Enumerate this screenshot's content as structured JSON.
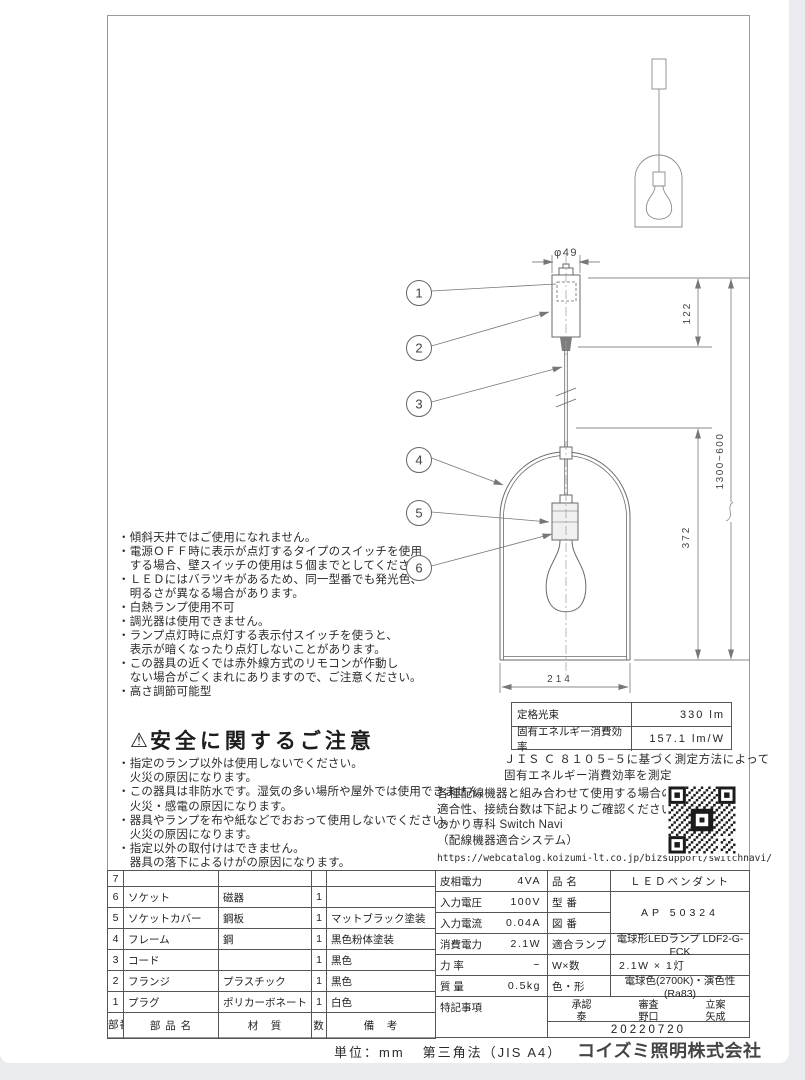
{
  "frame": {
    "unit_label": "単位：mm",
    "projection": "第三角法（JIS A4）",
    "company": "コイズミ照明株式会社"
  },
  "usage_notes": {
    "lines": [
      "・傾斜天井ではご使用になれません。",
      "・電源ＯＦＦ時に表示が点灯するタイプのスイッチを使用",
      "　する場合、壁スイッチの使用は５個までとしてください。",
      "・ＬＥＤにはバラツキがあるため、同一型番でも発光色、",
      "　明るさが異なる場合があります。",
      "・白熱ランプ使用不可",
      "・調光器は使用できません。",
      "・ランプ点灯時に点灯する表示付スイッチを使うと、",
      "　表示が暗くなったり点灯しないことがあります。",
      "・この器具の近くでは赤外線方式のリモコンが作動し",
      "　ない場合がごくまれにありますので、ご注意ください。",
      "・高さ調節可能型"
    ]
  },
  "safety": {
    "icon": "⚠",
    "title": "安全に関するご注意",
    "lines": [
      "・指定のランプ以外は使用しないでください。",
      "　火災の原因になります。",
      "・この器具は非防水です。湿気の多い場所や屋外では使用できません。",
      "　火災・感電の原因になります。",
      "・器具やランプを布や紙などでおおって使用しないでください。",
      "　火災の原因になります。",
      "・指定以外の取付けはできません。",
      "　器具の落下によるけがの原因になります。"
    ]
  },
  "drawing": {
    "dims": {
      "diameter": "φ49",
      "canopy_height": "122",
      "overall_height": "1300~600",
      "shade_height": "372",
      "shade_width": "214"
    },
    "callouts": [
      "1",
      "2",
      "3",
      "4",
      "5",
      "6"
    ]
  },
  "rating": {
    "rows": [
      {
        "label": "定格光束",
        "value": "330 lm"
      },
      {
        "label": "固有エネルギー消費効率",
        "value": "157.1 lm/W"
      }
    ],
    "note_line1": "ＪＩＳ Ｃ ８１０５−５に基づく測定方法によって",
    "note_line2": "固有エネルギー消費効率を測定"
  },
  "switch_navi": {
    "lines": [
      "各種配線機器と組み合わせて使用する場合の",
      "適合性、接続台数は下記よりご確認ください。",
      "あかり専科 Switch Navi",
      "（配線機器適合システム）"
    ],
    "url": "https://webcatalog.koizumi-lt.co.jp/bizsupport/switchnavi/"
  },
  "parts_table": {
    "header": {
      "no": "部番",
      "name": "部 品 名",
      "material": "材　質",
      "qty": "数",
      "note": "備　考"
    },
    "rows": [
      {
        "no": "7",
        "name": "",
        "material": "",
        "qty": "",
        "note": ""
      },
      {
        "no": "6",
        "name": "ソケット",
        "material": "磁器",
        "qty": "1",
        "note": ""
      },
      {
        "no": "5",
        "name": "ソケットカバー",
        "material": "鋼板",
        "qty": "1",
        "note": "マットブラック塗装"
      },
      {
        "no": "4",
        "name": "フレーム",
        "material": "鋼",
        "qty": "1",
        "note": "黒色粉体塗装"
      },
      {
        "no": "3",
        "name": "コード",
        "material": "",
        "qty": "1",
        "note": "黒色"
      },
      {
        "no": "2",
        "name": "フランジ",
        "material": "プラスチック",
        "qty": "1",
        "note": "黒色"
      },
      {
        "no": "1",
        "name": "プラグ",
        "material": "ポリカーボネート",
        "qty": "1",
        "note": "白色"
      }
    ]
  },
  "spec": {
    "electrical": [
      {
        "label": "皮相電力",
        "value": "4VA"
      },
      {
        "label": "入力電圧",
        "value": "100V"
      },
      {
        "label": "入力電流",
        "value": "0.04A"
      },
      {
        "label": "消費電力",
        "value": "2.1W"
      },
      {
        "label": "力 率",
        "value": "−"
      },
      {
        "label": "質 量",
        "value": "0.5kg"
      }
    ],
    "notes_label": "特記事項",
    "product": {
      "name_label": "品 名",
      "name": "ＬＥＤペンダント",
      "model_label": "型 番",
      "drawing_label": "図 番",
      "model_no": "AP 50324",
      "lamp_label": "適合ランプ",
      "lamp": "電球形LEDランプ LDF2-G-FCK",
      "wattage_label": "W×数",
      "wattage": "2.1W × 1灯",
      "color_label": "色・形",
      "color": "電球色(2700K)・演色性(Ra83)"
    },
    "approval": {
      "cols": [
        {
          "title": "承認",
          "name": "泰"
        },
        {
          "title": "審査",
          "name": "野口"
        },
        {
          "title": "立案",
          "name": "矢成"
        }
      ],
      "date": "20220720"
    }
  }
}
